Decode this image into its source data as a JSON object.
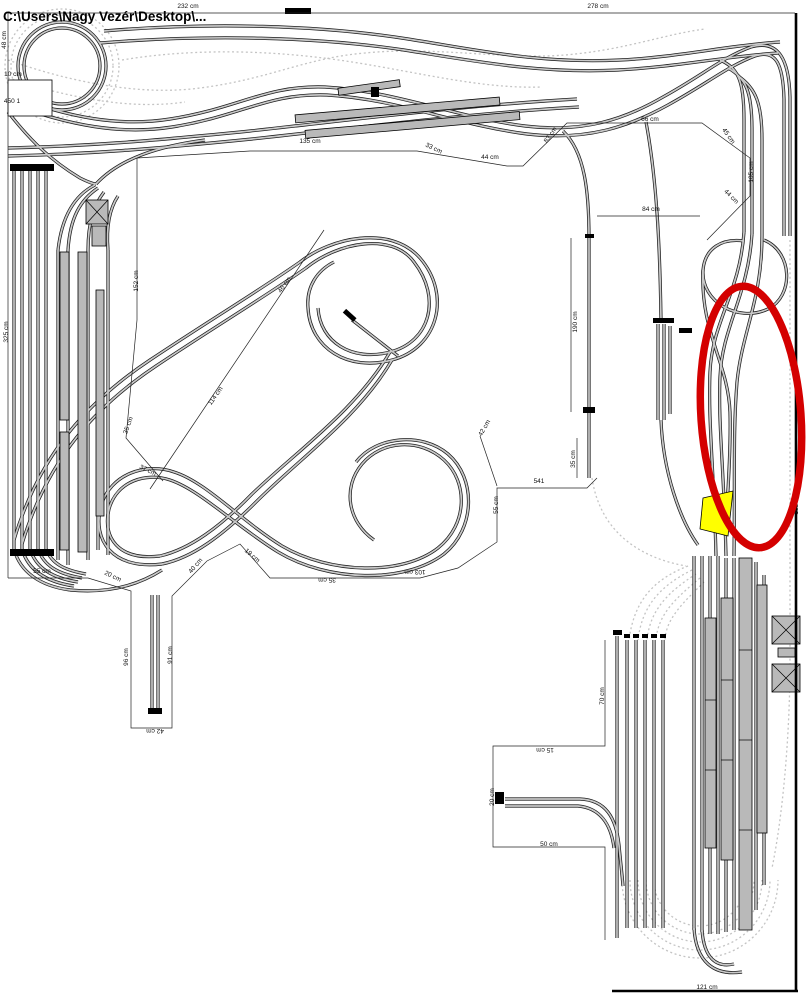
{
  "window": {
    "title_path": "C:\\Users\\Nagy Vezér\\Desktop\\..."
  },
  "annotations": {
    "attention_ellipse": {
      "color": "#d40000"
    },
    "selected_piece": {
      "color": "#ffff00"
    }
  },
  "canvas": {
    "background": "#ffffff",
    "track_gray": "#c9c9c9",
    "hidden_track_gray": "#c4c4c4",
    "outline_black": "#1c1c1c"
  },
  "labels": [
    {
      "text": "232 cm",
      "x": 188,
      "y": 8,
      "rot": 0
    },
    {
      "text": "278 cm",
      "x": 598,
      "y": 8,
      "rot": 0
    },
    {
      "text": "48 cm",
      "x": 6,
      "y": 40,
      "rot": -90
    },
    {
      "text": "10 cm",
      "x": 13,
      "y": 76,
      "rot": 0
    },
    {
      "text": "450 1",
      "x": 12,
      "y": 103,
      "rot": 0
    },
    {
      "text": "325 cm",
      "x": 8,
      "y": 332,
      "rot": -90
    },
    {
      "text": "135 cm",
      "x": 310,
      "y": 143,
      "rot": 0
    },
    {
      "text": "33 cm",
      "x": 433,
      "y": 150,
      "rot": 25
    },
    {
      "text": "44 cm",
      "x": 490,
      "y": 159,
      "rot": 0
    },
    {
      "text": "83 cm",
      "x": 552,
      "y": 136,
      "rot": -55
    },
    {
      "text": "66 cm",
      "x": 650,
      "y": 121,
      "rot": 0
    },
    {
      "text": "45 cm",
      "x": 727,
      "y": 137,
      "rot": 55
    },
    {
      "text": "105 cm",
      "x": 753,
      "y": 172,
      "rot": -90
    },
    {
      "text": "44 cm",
      "x": 730,
      "y": 198,
      "rot": 45
    },
    {
      "text": "84 cm",
      "x": 651,
      "y": 211,
      "rot": 0
    },
    {
      "text": "152 cm",
      "x": 138,
      "y": 281,
      "rot": -90
    },
    {
      "text": "46 cm",
      "x": 286,
      "y": 286,
      "rot": -55
    },
    {
      "text": "114 cm",
      "x": 217,
      "y": 397,
      "rot": -55
    },
    {
      "text": "35 cm",
      "x": 130,
      "y": 426,
      "rot": -70
    },
    {
      "text": "37 cm",
      "x": 147,
      "y": 472,
      "rot": 25
    },
    {
      "text": "190 cm",
      "x": 577,
      "y": 322,
      "rot": -90
    },
    {
      "text": "42 cm",
      "x": 486,
      "y": 429,
      "rot": -60
    },
    {
      "text": "35 cm",
      "x": 575,
      "y": 459,
      "rot": -90
    },
    {
      "text": "541",
      "x": 539,
      "y": 483,
      "rot": 0
    },
    {
      "text": "55 cm",
      "x": 498,
      "y": 505,
      "rot": -90
    },
    {
      "text": "55 cm",
      "x": 42,
      "y": 573,
      "rot": 0
    },
    {
      "text": "20 cm",
      "x": 112,
      "y": 578,
      "rot": 25
    },
    {
      "text": "40 cm",
      "x": 197,
      "y": 567,
      "rot": -50
    },
    {
      "text": "19 cm",
      "x": 251,
      "y": 557,
      "rot": 40
    },
    {
      "text": "35 cm",
      "x": 327,
      "y": 578,
      "rot": 180
    },
    {
      "text": "103 cm",
      "x": 415,
      "y": 570,
      "rot": 180
    },
    {
      "text": "96 cm",
      "x": 128,
      "y": 657,
      "rot": -90
    },
    {
      "text": "91 cm",
      "x": 172,
      "y": 655,
      "rot": -90
    },
    {
      "text": "42 cm",
      "x": 155,
      "y": 729,
      "rot": 180
    },
    {
      "text": "15 cm",
      "x": 545,
      "y": 748,
      "rot": 180
    },
    {
      "text": "20 cm",
      "x": 494,
      "y": 797,
      "rot": -90
    },
    {
      "text": "50 cm",
      "x": 549,
      "y": 846,
      "rot": 0
    },
    {
      "text": "70 cm",
      "x": 604,
      "y": 696,
      "rot": -90
    },
    {
      "text": "188 cm",
      "x": 798,
      "y": 504,
      "rot": -90
    },
    {
      "text": "121 cm",
      "x": 707,
      "y": 989,
      "rot": 0
    }
  ]
}
